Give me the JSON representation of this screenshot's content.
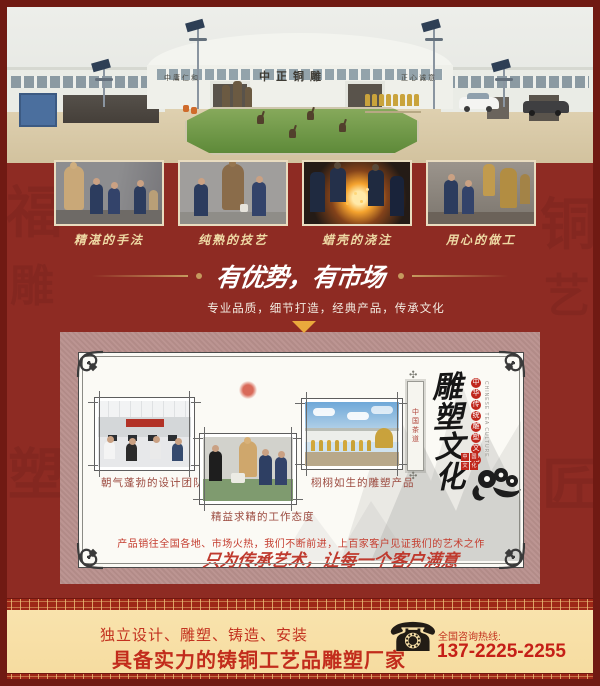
{
  "colors": {
    "maroon_bg": "#8e2b23",
    "maroon_border": "#701a13",
    "gold_accent": "#c59a5e",
    "triangle_gold": "#eaa93c",
    "pink_band": "#b88f8c",
    "card_bg": "#fbfaf5",
    "caption_gold": "#eed9a4",
    "red_text": "#c3321f",
    "footer_cream": "#f8e1a9"
  },
  "header_photo": {
    "signs": [
      "中庸仁和",
      "中正铜雕",
      "正心诚意"
    ]
  },
  "process_photos": [
    {
      "caption": "精湛的手法"
    },
    {
      "caption": "纯熟的技艺"
    },
    {
      "caption": "蜡壳的浇注"
    },
    {
      "caption": "用心的做工"
    }
  ],
  "divider": {
    "title": "有优势，有市场",
    "subtitle": "专业品质，细节打造，经典产品，传承文化"
  },
  "culture_card": {
    "photos": [
      {
        "caption": "朝气蓬勃的设计团队"
      },
      {
        "caption": "精益求精的工作态度"
      },
      {
        "caption": "栩栩如生的雕塑产品"
      }
    ],
    "vertical_title": "雕塑文化",
    "vertical_subtitle": "中华传统雕塑文化",
    "vertical_english": "CHINESE TEA CULTURE",
    "bookmark_text": "中国茶道",
    "seal_text": "中国文化",
    "body": "产品销往全国各地、市场火热，我们不断前进，上百家客户见证我们的艺术之作",
    "slogan": "只为传承艺术，让每一个客户满意"
  },
  "footer": {
    "line1": "独立设计、雕塑、铸造、安装",
    "line2": "具备实力的铸铜工艺品雕塑厂家",
    "hotline_label": "全国咨询热线:",
    "phone": "137-2225-2255",
    "phone_icon": "☎"
  },
  "decor": {
    "watermark_chars": "福雕铜艺塑匠"
  }
}
